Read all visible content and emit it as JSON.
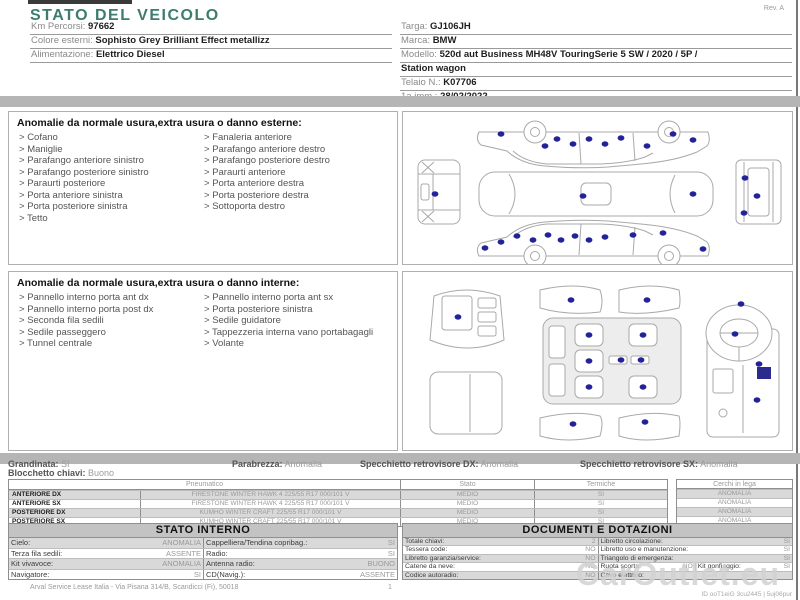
{
  "page": {
    "title": "STATO DEL VEICOLO",
    "rev": "Rev. A",
    "footer_company": "Arval Service Lease Italia - Via Pisana 314/B, Scandicci (Fi), 50018",
    "footer_page": "1",
    "watermark_brand": "CarOutlet.eu",
    "watermark_id": "ID ooT1eiG 3cu2445 | 5uj06pur"
  },
  "header": {
    "left": [
      {
        "label": "Km Percorsi:",
        "value": "97662"
      },
      {
        "label": "Colore esterni:",
        "value": "Sophisto Grey Brilliant Effect metallizz"
      },
      {
        "label": "Alimentazione:",
        "value": "Elettrico Diesel"
      }
    ],
    "right": [
      {
        "label": "Targa:",
        "value": "GJ106JH"
      },
      {
        "label": "Marca:",
        "value": "BMW"
      },
      {
        "label": "Modello:",
        "value": "520d aut Business MH48V TouringSerie 5 SW / 2020 / 5P /"
      },
      {
        "label": "",
        "value": "Station wagon"
      },
      {
        "label": "Telaio N.:",
        "value": "K07706"
      },
      {
        "label": "1a imm.:",
        "value": "28/02/2022"
      }
    ]
  },
  "exterior": {
    "title": "Anomalie da normale usura,extra usura o danno esterne:",
    "col1": [
      "Cofano",
      "Maniglie",
      "Parafango anteriore sinistro",
      "Parafango posteriore sinistro",
      "Paraurti posteriore",
      "Porta anteriore sinistra",
      "Porta posteriore sinistra",
      "Tetto"
    ],
    "col2": [
      "Fanaleria anteriore",
      "Parafango anteriore destro",
      "Parafango posteriore destro",
      "Paraurti anteriore",
      "Porta anteriore destra",
      "Porta posteriore destra",
      "Sottoporta destro"
    ]
  },
  "interior": {
    "title": "Anomalie da normale usura,extra usura o danno interne:",
    "col1": [
      "Pannello interno porta ant dx",
      "Pannello interno porta post dx",
      "Seconda fila sedili",
      "Sedile passeggero",
      "Tunnel centrale"
    ],
    "col2": [
      "Pannello interno porta ant sx",
      "Porta posteriore sinistra",
      "Sedile guidatore",
      "Tappezzeria interna vano portabagagli",
      "Volante"
    ]
  },
  "status_line": [
    {
      "label": "Grandinata:",
      "value": "SI"
    },
    {
      "label": "Blocchetto chiavi:",
      "value": "Buono"
    },
    {
      "label": "Parabrezza:",
      "value": "Anomalia"
    },
    {
      "label": "Specchietto retrovisore DX:",
      "value": "Anomalia"
    },
    {
      "label": "Specchietto retrovisore SX:",
      "value": "Anomalia"
    }
  ],
  "tyres": {
    "headers": [
      "Pneumatico",
      "Stato",
      "Termiche",
      "Cerchi in lega"
    ],
    "rows": [
      {
        "position": "ANTERIORE DX",
        "model": "FIRESTONE WINTER HAWK 4 225/55 R17 000/101 V",
        "stato": "MEDIO",
        "termiche": "SI",
        "cerchi": "ANOMALIA"
      },
      {
        "position": "ANTERIORE SX",
        "model": "FIRESTONE WINTER HAWK 4 225/55 R17 000/101 V",
        "stato": "MEDIO",
        "termiche": "SI",
        "cerchi": "ANOMALIA"
      },
      {
        "position": "POSTERIORE DX",
        "model": "KUMHO WINTER CRAFT 225/55 R17 000/101 V",
        "stato": "MEDIO",
        "termiche": "SI",
        "cerchi": "ANOMALIA"
      },
      {
        "position": "POSTERIORE SX",
        "model": "KUMHO WINTER CRAFT 225/55 R17 000/101 V",
        "stato": "MEDIO",
        "termiche": "SI",
        "cerchi": "ANOMALIA"
      }
    ]
  },
  "stato_interno": {
    "title": "STATO INTERNO",
    "rows": [
      [
        {
          "label": "Cielo:",
          "value": "ANOMALIA"
        },
        {
          "label": "Cappelliera/Tendina copribag.:",
          "value": "SI"
        }
      ],
      [
        {
          "label": "Terza fila sedili:",
          "value": "ASSENTE"
        },
        {
          "label": "Radio:",
          "value": "SI"
        }
      ],
      [
        {
          "label": "Kit vivavoce:",
          "value": "ANOMALIA"
        },
        {
          "label": "Antenna radio:",
          "value": "BUONO"
        }
      ],
      [
        {
          "label": "Navigatore:",
          "value": "SI"
        },
        {
          "label": "CD(Navig.):",
          "value": "ASSENTE"
        }
      ]
    ]
  },
  "documenti": {
    "title": "DOCUMENTI E DOTAZIONI",
    "rows": [
      [
        {
          "label": "Totale chiavi:",
          "value": "2"
        },
        {
          "label": "Libretto circolazione:",
          "value": "SI"
        }
      ],
      [
        {
          "label": "Tessera code:",
          "value": "NO"
        },
        {
          "label": "Libretto uso e manutenzione:",
          "value": "SI"
        }
      ],
      [
        {
          "label": "Libretto garanzia/service:",
          "value": "NO"
        },
        {
          "label": "Triangolo di emergenza:",
          "value": "SI"
        }
      ],
      [
        {
          "label": "Catene da neve:",
          "value": "NO"
        },
        {
          "label": "Ruota scorta:",
          "value": "NO"
        },
        {
          "label": "Kit gonfiaggio:",
          "value": "SI"
        }
      ],
      [
        {
          "label": "Codice autoradio:",
          "value": "NO"
        },
        {
          "label": "Cavo elettrico:",
          "value": ""
        }
      ]
    ]
  },
  "diagrams": {
    "exterior_damage_points": [
      [
        98,
        22
      ],
      [
        142,
        34
      ],
      [
        154,
        27
      ],
      [
        170,
        32
      ],
      [
        186,
        27
      ],
      [
        202,
        32
      ],
      [
        218,
        26
      ],
      [
        244,
        34
      ],
      [
        270,
        22
      ],
      [
        290,
        28
      ],
      [
        32,
        82
      ],
      [
        180,
        84
      ],
      [
        290,
        82
      ],
      [
        342,
        66
      ],
      [
        354,
        84
      ],
      [
        341,
        101
      ],
      [
        82,
        136
      ],
      [
        98,
        130
      ],
      [
        114,
        124
      ],
      [
        130,
        128
      ],
      [
        145,
        123
      ],
      [
        158,
        128
      ],
      [
        172,
        124
      ],
      [
        186,
        128
      ],
      [
        202,
        125
      ],
      [
        230,
        123
      ],
      [
        260,
        121
      ],
      [
        300,
        137
      ]
    ],
    "interior_damage_points": [
      [
        55,
        45
      ],
      [
        168,
        28
      ],
      [
        244,
        28
      ],
      [
        186,
        63
      ],
      [
        240,
        63
      ],
      [
        186,
        89
      ],
      [
        186,
        115
      ],
      [
        240,
        115
      ],
      [
        218,
        88
      ],
      [
        238,
        88
      ],
      [
        170,
        152
      ],
      [
        242,
        150
      ],
      [
        332,
        62
      ],
      [
        338,
        32
      ],
      [
        356,
        92
      ],
      [
        354,
        128
      ]
    ]
  },
  "colors": {
    "title_teal": "#3E7C6E",
    "damage_dot": "#22229A",
    "band_gray": "#B5B5B5",
    "row_alt_gray": "#D9D9D9",
    "table_header_bar": "#C3C3C3"
  }
}
